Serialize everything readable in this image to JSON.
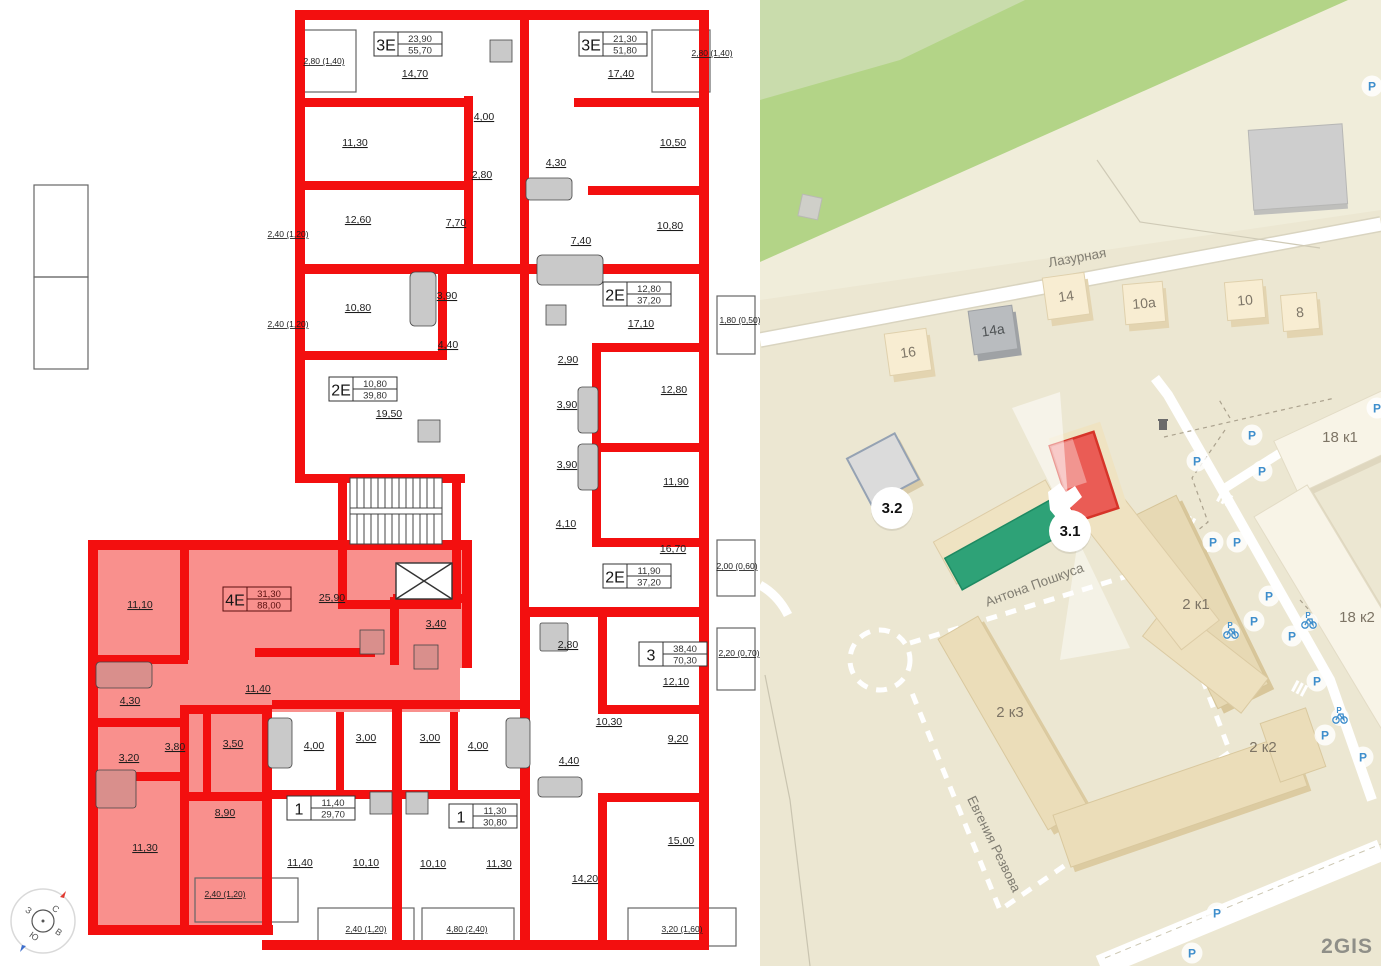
{
  "floorplan": {
    "wall_color": "#f30f0f",
    "highlight_fill": "#f9908d",
    "apartments": [
      {
        "type": "3Е",
        "upper": "23,90",
        "lower": "55,70",
        "x": 374,
        "y": 32,
        "bg": "#ffffff"
      },
      {
        "type": "3Е",
        "upper": "21,30",
        "lower": "51,80",
        "x": 579,
        "y": 32,
        "bg": "#ffffff"
      },
      {
        "type": "2Е",
        "upper": "12,80",
        "lower": "37,20",
        "x": 603,
        "y": 282,
        "bg": "#ffffff"
      },
      {
        "type": "2Е",
        "upper": "10,80",
        "lower": "39,80",
        "x": 329,
        "y": 377,
        "bg": "#ffffff"
      },
      {
        "type": "4Е",
        "upper": "31,30",
        "lower": "88,00",
        "x": 223,
        "y": 587,
        "bg": "#f9908d"
      },
      {
        "type": "2Е",
        "upper": "11,90",
        "lower": "37,20",
        "x": 603,
        "y": 564,
        "bg": "#ffffff"
      },
      {
        "type": "3",
        "upper": "38,40",
        "lower": "70,30",
        "x": 639,
        "y": 642,
        "bg": "#ffffff"
      },
      {
        "type": "1",
        "upper": "11,40",
        "lower": "29,70",
        "x": 287,
        "y": 796,
        "bg": "#ffffff"
      },
      {
        "type": "1",
        "upper": "11,30",
        "lower": "30,80",
        "x": 449,
        "y": 804,
        "bg": "#ffffff"
      }
    ],
    "room_labels": [
      {
        "t": "14,70",
        "x": 415,
        "y": 77
      },
      {
        "t": "11,30",
        "x": 355,
        "y": 146
      },
      {
        "t": "12,60",
        "x": 358,
        "y": 223
      },
      {
        "t": "7,70",
        "x": 456,
        "y": 226
      },
      {
        "t": "4,00",
        "x": 484,
        "y": 120
      },
      {
        "t": "2,80",
        "x": 482,
        "y": 178
      },
      {
        "t": "17,40",
        "x": 621,
        "y": 77
      },
      {
        "t": "10,50",
        "x": 673,
        "y": 146
      },
      {
        "t": "10,80",
        "x": 670,
        "y": 229
      },
      {
        "t": "7,40",
        "x": 581,
        "y": 244
      },
      {
        "t": "4,30",
        "x": 556,
        "y": 166
      },
      {
        "t": "2,80 (1,40)",
        "x": 324,
        "y": 64,
        "small": true
      },
      {
        "t": "2,80 (1,40)",
        "x": 712,
        "y": 56,
        "small": true
      },
      {
        "t": "2,40 (1,20)",
        "x": 288,
        "y": 237,
        "small": true
      },
      {
        "t": "2,40 (1,20)",
        "x": 288,
        "y": 327,
        "small": true
      },
      {
        "t": "1,80 (0,50)",
        "x": 740,
        "y": 323,
        "small": true
      },
      {
        "t": "10,80",
        "x": 358,
        "y": 311
      },
      {
        "t": "3,90",
        "x": 447,
        "y": 299
      },
      {
        "t": "4,40",
        "x": 448,
        "y": 348
      },
      {
        "t": "19,50",
        "x": 389,
        "y": 417
      },
      {
        "t": "17,10",
        "x": 641,
        "y": 327
      },
      {
        "t": "2,90",
        "x": 568,
        "y": 363
      },
      {
        "t": "12,80",
        "x": 674,
        "y": 393
      },
      {
        "t": "3,90",
        "x": 567,
        "y": 408
      },
      {
        "t": "3,90",
        "x": 567,
        "y": 468
      },
      {
        "t": "11,90",
        "x": 676,
        "y": 485
      },
      {
        "t": "4,10",
        "x": 566,
        "y": 527
      },
      {
        "t": "16,70",
        "x": 673,
        "y": 552
      },
      {
        "t": "2,00 (0,60)",
        "x": 737,
        "y": 569,
        "small": true
      },
      {
        "t": "2,80",
        "x": 568,
        "y": 648
      },
      {
        "t": "12,10",
        "x": 676,
        "y": 685
      },
      {
        "t": "10,30",
        "x": 609,
        "y": 725
      },
      {
        "t": "9,20",
        "x": 678,
        "y": 742
      },
      {
        "t": "4,40",
        "x": 569,
        "y": 764
      },
      {
        "t": "15,00",
        "x": 681,
        "y": 844
      },
      {
        "t": "14,20",
        "x": 585,
        "y": 882
      },
      {
        "t": "2,20 (0,70)",
        "x": 739,
        "y": 656,
        "small": true
      },
      {
        "t": "3,20 (1,60)",
        "x": 682,
        "y": 932,
        "small": true
      },
      {
        "t": "11,10",
        "x": 140,
        "y": 608
      },
      {
        "t": "25,90",
        "x": 332,
        "y": 601
      },
      {
        "t": "3,40",
        "x": 436,
        "y": 627
      },
      {
        "t": "4,30",
        "x": 130,
        "y": 704
      },
      {
        "t": "11,40",
        "x": 258,
        "y": 692
      },
      {
        "t": "3,20",
        "x": 129,
        "y": 761
      },
      {
        "t": "3,80",
        "x": 175,
        "y": 750
      },
      {
        "t": "3,50",
        "x": 233,
        "y": 747
      },
      {
        "t": "8,90",
        "x": 225,
        "y": 816
      },
      {
        "t": "11,30",
        "x": 145,
        "y": 851
      },
      {
        "t": "2,40 (1,20)",
        "x": 225,
        "y": 897,
        "small": true
      },
      {
        "t": "4,00",
        "x": 314,
        "y": 749
      },
      {
        "t": "3,00",
        "x": 366,
        "y": 741
      },
      {
        "t": "11,40",
        "x": 300,
        "y": 866
      },
      {
        "t": "10,10",
        "x": 366,
        "y": 866
      },
      {
        "t": "2,40 (1,20)",
        "x": 366,
        "y": 932,
        "small": true
      },
      {
        "t": "3,00",
        "x": 430,
        "y": 741
      },
      {
        "t": "4,00",
        "x": 478,
        "y": 749
      },
      {
        "t": "10,10",
        "x": 433,
        "y": 867
      },
      {
        "t": "11,30",
        "x": 499,
        "y": 867
      },
      {
        "t": "4,80 (2,40)",
        "x": 467,
        "y": 932,
        "small": true
      }
    ]
  },
  "map": {
    "colors": {
      "green_area": "#b3d487",
      "highlight_green": "#2ea277",
      "highlight_red": "#ea5c55",
      "parking_blue": "#3e8ecc"
    },
    "streets": [
      {
        "name": "Лазурная",
        "x": 318,
        "y": 262,
        "rot": -10
      },
      {
        "name": "Антона Пошкуса",
        "x": 276,
        "y": 589,
        "rot": -20
      },
      {
        "name": "Евгения Резвова",
        "x": 230,
        "y": 846,
        "rot": 64
      }
    ],
    "markers": [
      {
        "label": "3.2",
        "x": 132,
        "y": 508
      },
      {
        "label": "3.1",
        "x": 310,
        "y": 531
      }
    ],
    "small_buildings": [
      {
        "label": "16",
        "x": 148,
        "y": 352,
        "size": 42,
        "rot": -8,
        "variant": "cream"
      },
      {
        "label": "14а",
        "x": 233,
        "y": 330,
        "size": 44,
        "rot": -8,
        "variant": "gray"
      },
      {
        "label": "14",
        "x": 306,
        "y": 296,
        "size": 42,
        "rot": -8,
        "variant": "cream"
      },
      {
        "label": "10а",
        "x": 384,
        "y": 303,
        "size": 40,
        "rot": -5,
        "variant": "cream"
      },
      {
        "label": "10",
        "x": 485,
        "y": 300,
        "size": 38,
        "rot": -5,
        "variant": "cream"
      },
      {
        "label": "8",
        "x": 540,
        "y": 312,
        "size": 36,
        "rot": -5,
        "variant": "cream"
      }
    ],
    "slab_labels": [
      {
        "label": "18 к1",
        "x": 580,
        "y": 442
      },
      {
        "label": "18 к2",
        "x": 597,
        "y": 622
      },
      {
        "label": "2 к1",
        "x": 436,
        "y": 609
      },
      {
        "label": "2 к3",
        "x": 250,
        "y": 717
      },
      {
        "label": "2 к2",
        "x": 503,
        "y": 752
      }
    ],
    "parking": [
      {
        "x": 437,
        "y": 461
      },
      {
        "x": 492,
        "y": 435
      },
      {
        "x": 502,
        "y": 471
      },
      {
        "x": 453,
        "y": 542
      },
      {
        "x": 477,
        "y": 542
      },
      {
        "x": 509,
        "y": 596
      },
      {
        "x": 494,
        "y": 621
      },
      {
        "x": 532,
        "y": 636
      },
      {
        "x": 557,
        "y": 681
      },
      {
        "x": 565,
        "y": 735
      },
      {
        "x": 603,
        "y": 757
      },
      {
        "x": 457,
        "y": 913
      },
      {
        "x": 432,
        "y": 953
      },
      {
        "x": 617,
        "y": 408
      },
      {
        "x": 612,
        "y": 86
      }
    ],
    "bikes": [
      {
        "x": 471,
        "y": 632
      },
      {
        "x": 549,
        "y": 622
      },
      {
        "x": 580,
        "y": 717
      }
    ],
    "parking_letter": "P",
    "logo": "2GIS"
  }
}
